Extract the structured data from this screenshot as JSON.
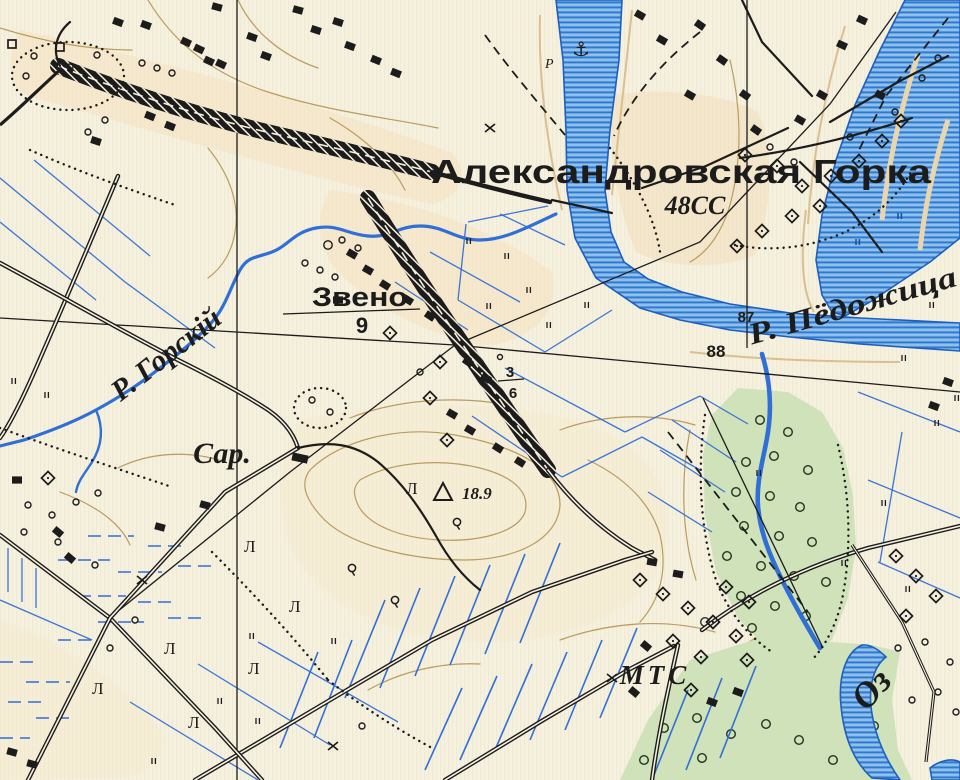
{
  "map": {
    "kind": "historical-topographic-map",
    "language": "Russian (pre-reform orthography)",
    "labels": {
      "main_settlement": "Александровская Горка",
      "main_settlement_code": "48СС",
      "zveno": "Звено",
      "zveno_count": "9",
      "sar": "Сар.",
      "river_gorskiy": "Р. Горскій",
      "river_pedozhitsa": "Р. Пёдожица",
      "mts": "МТС",
      "lake_abbrev": "Оз",
      "elevation_mark": "18.9",
      "spot_height_87": "87",
      "spot_height_88": "88",
      "fraction_numerator": "3",
      "fraction_denominator": "6",
      "pier_mark": "Р",
      "tree_species_symbol": "Л"
    },
    "icons": {
      "anchor": "⚓",
      "elevation_triangle": "triangle-survey-mark",
      "road_cross": "x-road-mark"
    },
    "colors": {
      "paper": "#f6f0de",
      "paper_tint": "#f6e2c0",
      "water_light": "#8fc0ec",
      "water_stripe": "#2f79d0",
      "water_outline": "#1d5fc0",
      "hydro_line": "#2f6fd6",
      "contour_tan": "#b99c5e",
      "vegetation_green": "#cfe2ba",
      "ink": "#1c1c1c"
    }
  }
}
